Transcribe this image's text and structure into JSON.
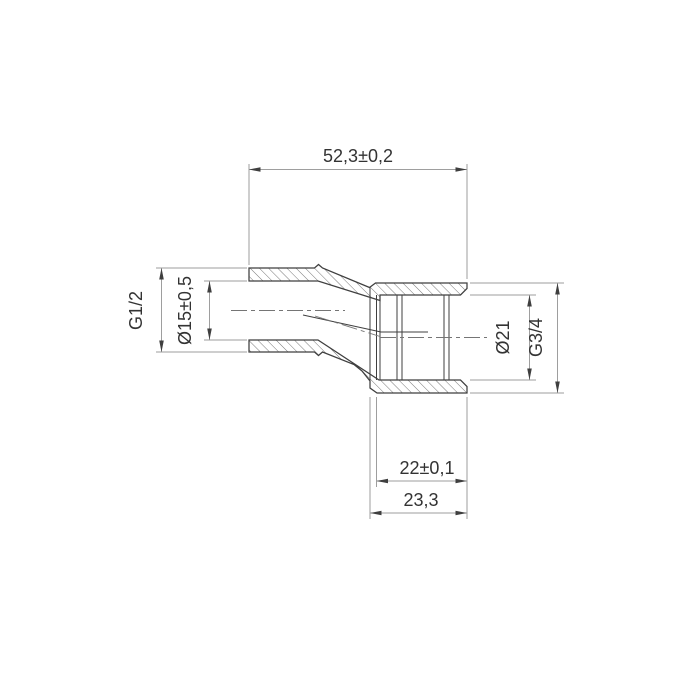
{
  "drawing": {
    "labels": {
      "overall_length": "52,3±0,2",
      "thread_left": "G1/2",
      "bore_left": "Ø15±0,5",
      "bore_right": "Ø21",
      "thread_right": "G3/4",
      "socket_depth": "22±0,1",
      "socket_length": "23,3"
    },
    "colors": {
      "background": "#ffffff",
      "part_line": "#3f3f3f",
      "dimension_line": "#9e9e9e",
      "text": "#333333"
    }
  }
}
